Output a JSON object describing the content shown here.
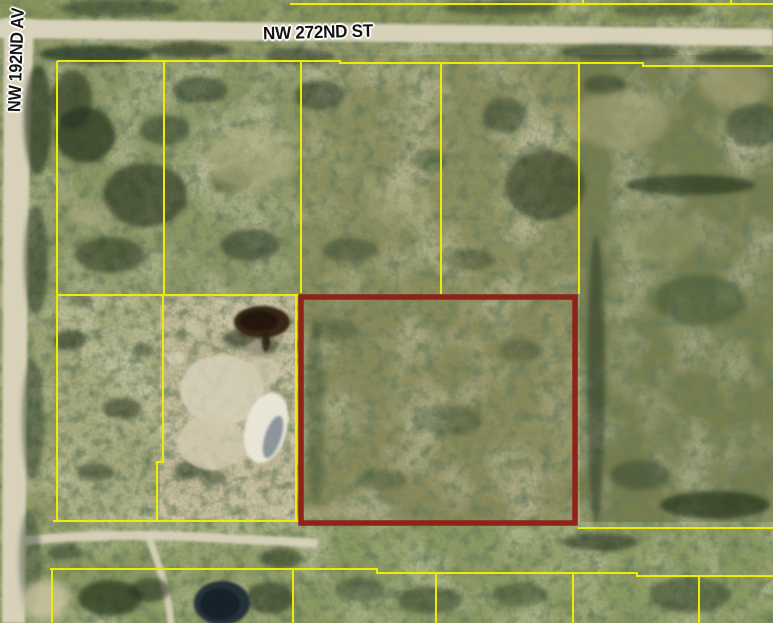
{
  "map": {
    "street_labels": {
      "horizontal": "NW 272ND ST",
      "vertical": "NW 192ND AV"
    },
    "colors": {
      "parcel_line": "#eded04",
      "highlight_outline": "#8e2317",
      "road": "#d8d2bb"
    }
  }
}
